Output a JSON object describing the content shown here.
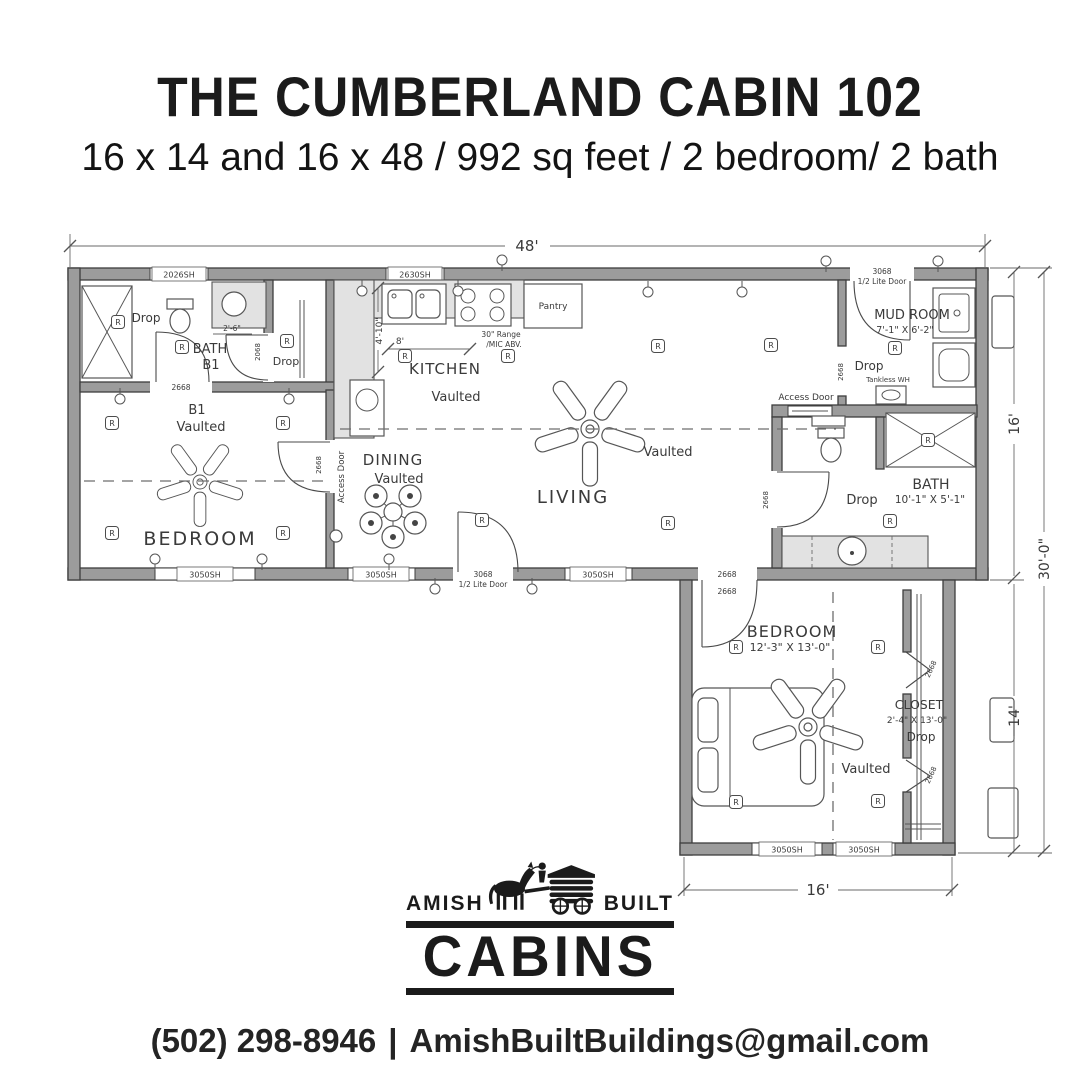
{
  "header": {
    "title": "THE CUMBERLAND CABIN 102",
    "subtitle": "16 x 14 and 16 x 48 / 992 sq feet / 2 bedroom/ 2 bath"
  },
  "plan": {
    "dims": {
      "overall_width": "48'",
      "main_depth": "16'",
      "overall_depth": "30'-0\"",
      "wing_depth": "14'",
      "wing_width": "16'",
      "kitchen_depth": "4'-10\"",
      "kitchen_run": "8'",
      "vanity_width": "2'-6\""
    },
    "rooms": {
      "bath1_line1": "BATH",
      "bath1_line2": "B1",
      "b1_label1": "B1",
      "b1_label2": "Vaulted",
      "b1_name": "BEDROOM",
      "kitchen": "KITCHEN",
      "dining": "DINING",
      "living": "LIVING",
      "mudroom": "MUD ROOM",
      "mudroom_size": "7'-1\" X 6'-2\"",
      "bath2": "BATH",
      "bath2_size": "10'-1\" X 5'-1\"",
      "bedroom2": "BEDROOM",
      "bedroom2_size": "12'-3\" X 13'-0\"",
      "closet": "CLOSET",
      "closet_size": "2'-4\" X 13'-0\""
    },
    "labels": {
      "vaulted": "Vaulted",
      "drop": "Drop",
      "access_door": "Access Door",
      "tankless": "Tankless WH",
      "pantry": "Pantry",
      "range_line1": "30\" Range",
      "range_line2": "/MIC ABV.",
      "receptacle": "R"
    },
    "openings": {
      "w2026": "2026SH",
      "w2630": "2630SH",
      "w3050": "3050SH",
      "door3068": "3068",
      "door3068_type": "1/2 Lite Door",
      "d2668": "2668",
      "d2068": "2068"
    }
  },
  "logo": {
    "amish": "AMISH",
    "built": "BUILT",
    "cabins": "CABINS"
  },
  "footer": {
    "phone": "(502) 298-8946",
    "separator": "|",
    "email": "AmishBuiltBuildings@gmail.com"
  }
}
